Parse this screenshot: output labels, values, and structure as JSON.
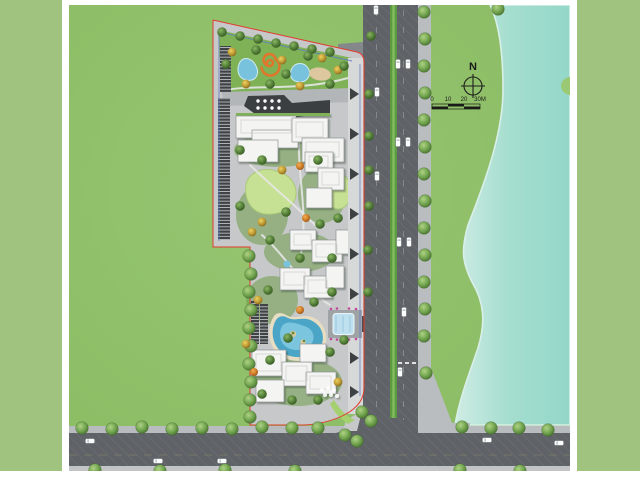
{
  "plan": {
    "type": "residential-masterplan-rendering",
    "compass": {
      "label": "N"
    },
    "scale_bar": {
      "ticks": [
        "0",
        "10",
        "20",
        "30M"
      ],
      "unit": "M"
    },
    "palette": {
      "frame_green": "#a0c47f",
      "lawn_green": "#8fbf68",
      "park_green": "#7fb257",
      "inner_lawn": "#c7e194",
      "water_teal": "#9adcce",
      "pool_blue": "#4aa5c6",
      "pond_blue": "#79c2dd",
      "road_gray": "#5f6367",
      "sidewalk_gray": "#babdbf",
      "building_white": "#f4f4f2",
      "boundary_red": "#e23b2e",
      "setback_blue": "#5f79c5",
      "feature_orange": "#e0752c",
      "sand_tan": "#dcc79e"
    }
  }
}
